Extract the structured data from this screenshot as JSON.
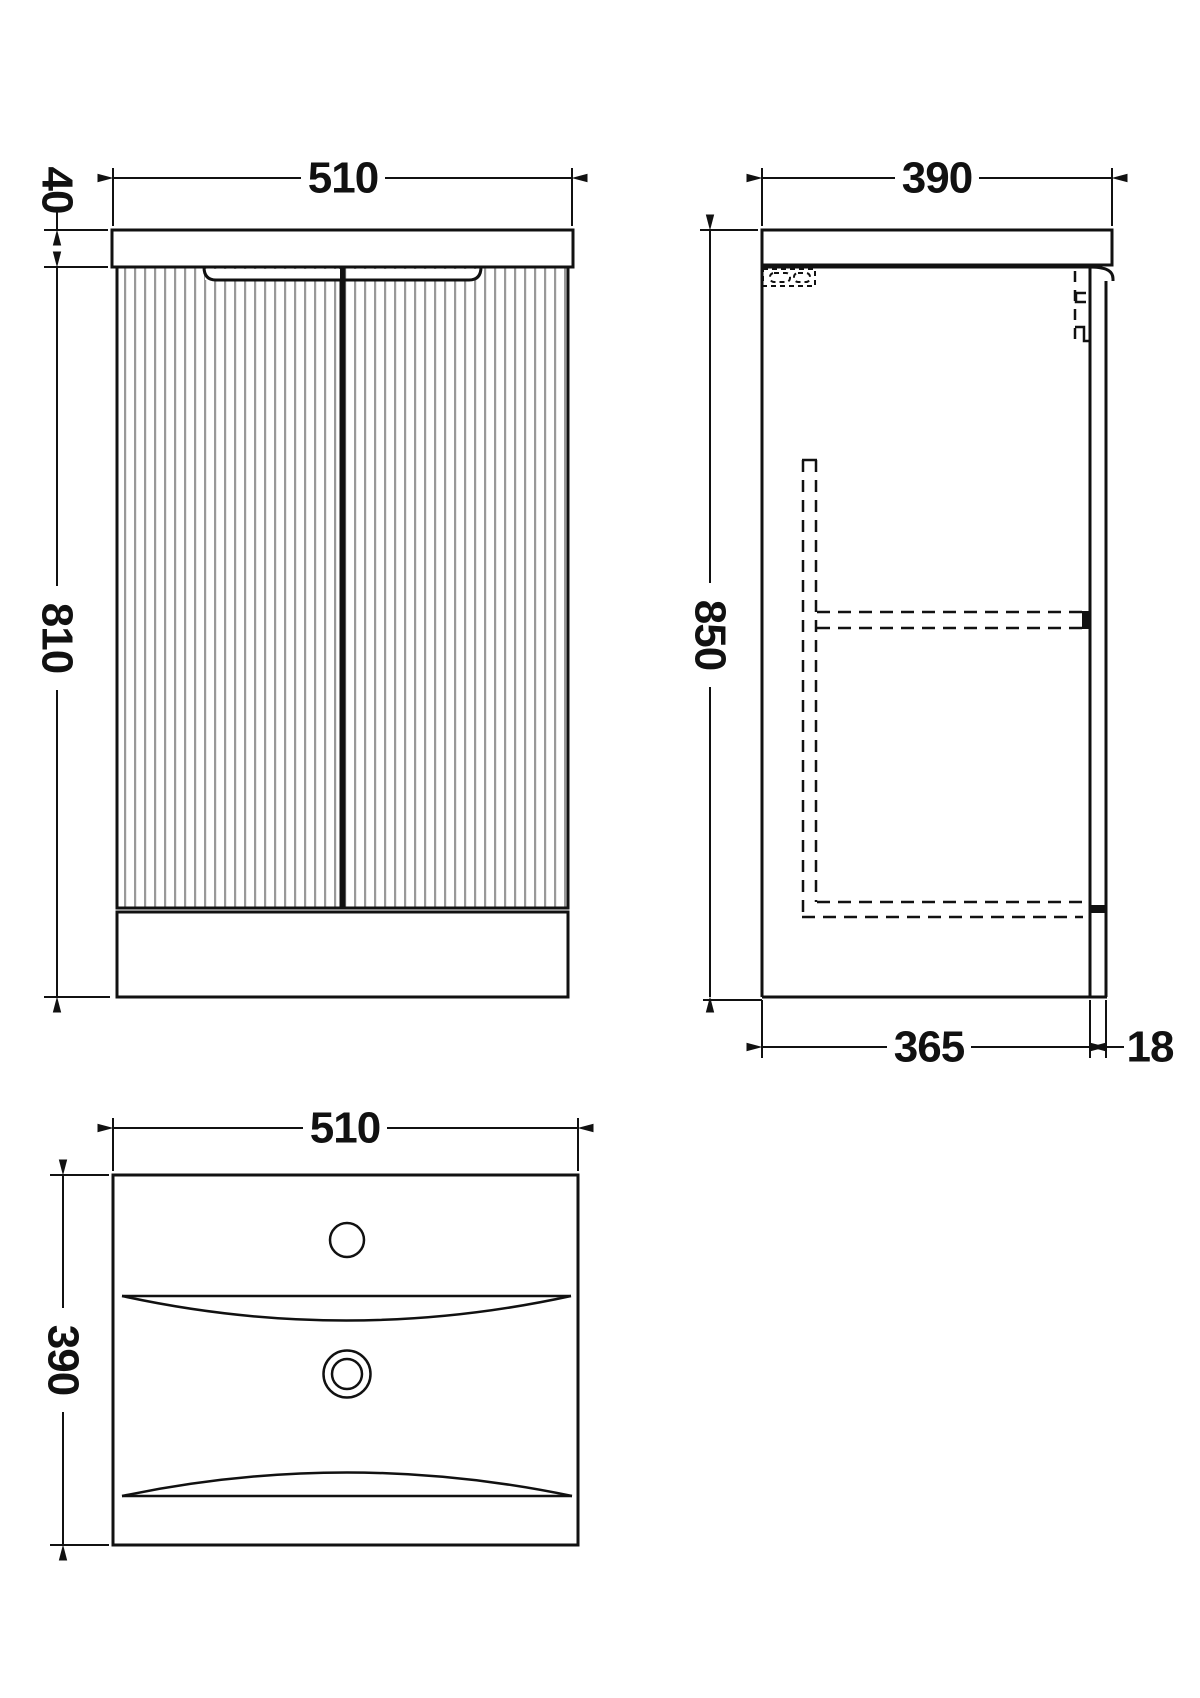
{
  "drawing": {
    "title": "vanity-unit-technical-drawing",
    "colors": {
      "line": "#111111",
      "flute": "#999999",
      "background": "#ffffff"
    },
    "views": {
      "front": {
        "dims": {
          "width": "510",
          "countertop_height": "40",
          "cabinet_height": "810"
        }
      },
      "side": {
        "dims": {
          "depth": "390",
          "overall_height": "850",
          "carcass_depth": "365",
          "door_thickness": "18"
        }
      },
      "plan": {
        "dims": {
          "width": "510",
          "depth": "390"
        }
      }
    }
  }
}
